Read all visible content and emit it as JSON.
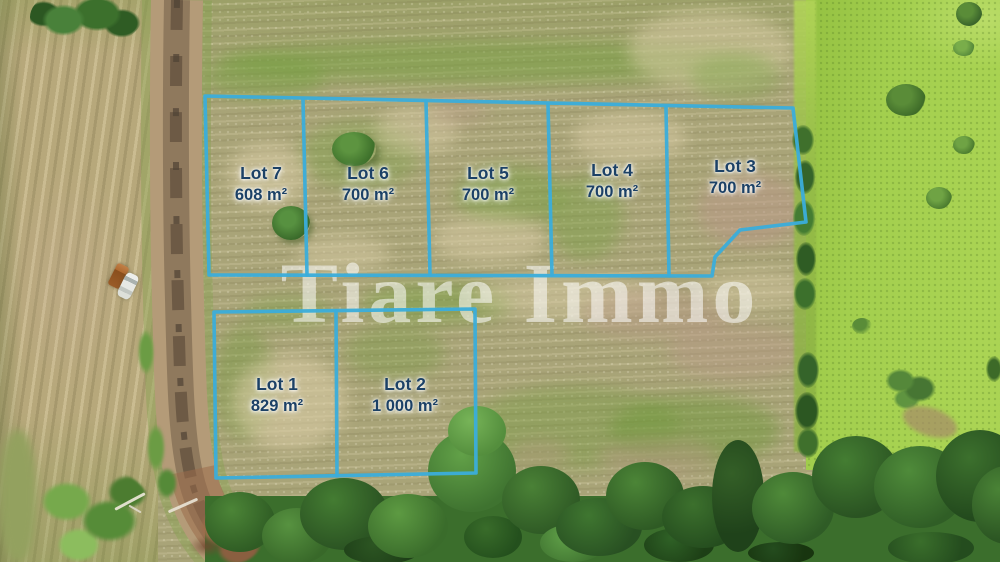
{
  "watermark": {
    "text": "Tiare Immo"
  },
  "lots": [
    {
      "name": "Lot 7",
      "area": "608 m²"
    },
    {
      "name": "Lot 6",
      "area": "700 m²"
    },
    {
      "name": "Lot 5",
      "area": "700 m²"
    },
    {
      "name": "Lot 4",
      "area": "700 m²"
    },
    {
      "name": "Lot 3",
      "area": "700 m²"
    },
    {
      "name": "Lot 1",
      "area": "829 m²"
    },
    {
      "name": "Lot 2",
      "area": "1 000 m²"
    }
  ],
  "colors": {
    "lot_boundary": "#3badda",
    "lot_label_text": "#1c4166",
    "watermark_text": "#ffffff"
  }
}
